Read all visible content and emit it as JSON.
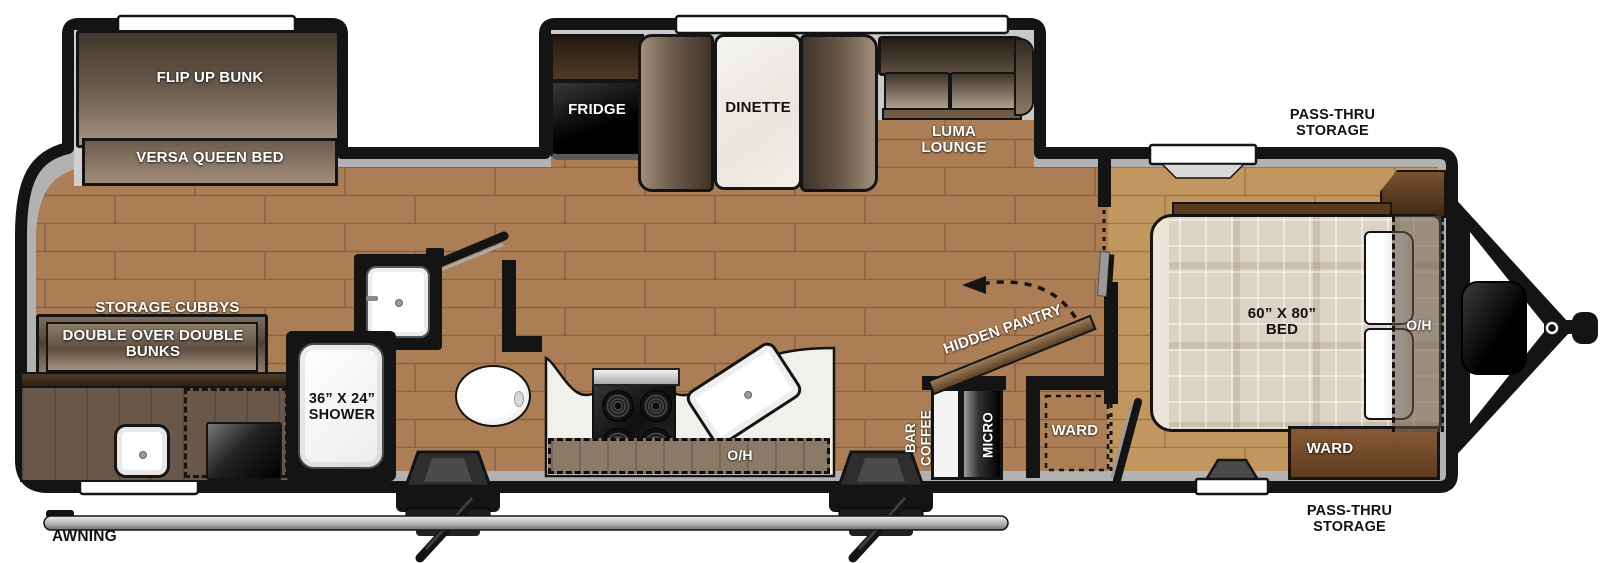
{
  "floorplan": {
    "labels": {
      "flip_up_bunk": "FLIP UP BUNK",
      "versa_queen_bed": "VERSA QUEEN BED",
      "storage_cubbys": "STORAGE CUBBYS",
      "double_bunks": "DOUBLE OVER DOUBLE BUNKS",
      "fridge": "FRIDGE",
      "dinette": "DINETTE",
      "luma_lounge": "LUMA LOUNGE",
      "shower": "36” X 24” SHOWER",
      "overhead_kitchen": "O/H",
      "coffee_bar": "COFFEE BAR",
      "micro": "MICRO",
      "hidden_pantry": "HIDDEN PANTRY",
      "ward_closet": "WARD",
      "bed": "60” X 80” BED",
      "overhead_bed": "O/H",
      "ward_bedroom": "WARD",
      "pass_thru_top": "PASS-THRU STORAGE",
      "pass_thru_bottom": "PASS-THRU STORAGE",
      "awning": "AWNING"
    },
    "colors": {
      "wall": "#141414",
      "floor_main": "#ac7e55",
      "floor_bedroom": "#c59a6b",
      "trim_gray": "#b2b2b2",
      "furniture_dark_brown": "#4e4133",
      "furniture_light_brown": "#a6957f",
      "cabinet_wood": "#5f3c1e",
      "counter_white": "#f2f0eb",
      "appliance_black": "#1b1b1b",
      "mattress_beige": "#dcd3c6"
    }
  }
}
